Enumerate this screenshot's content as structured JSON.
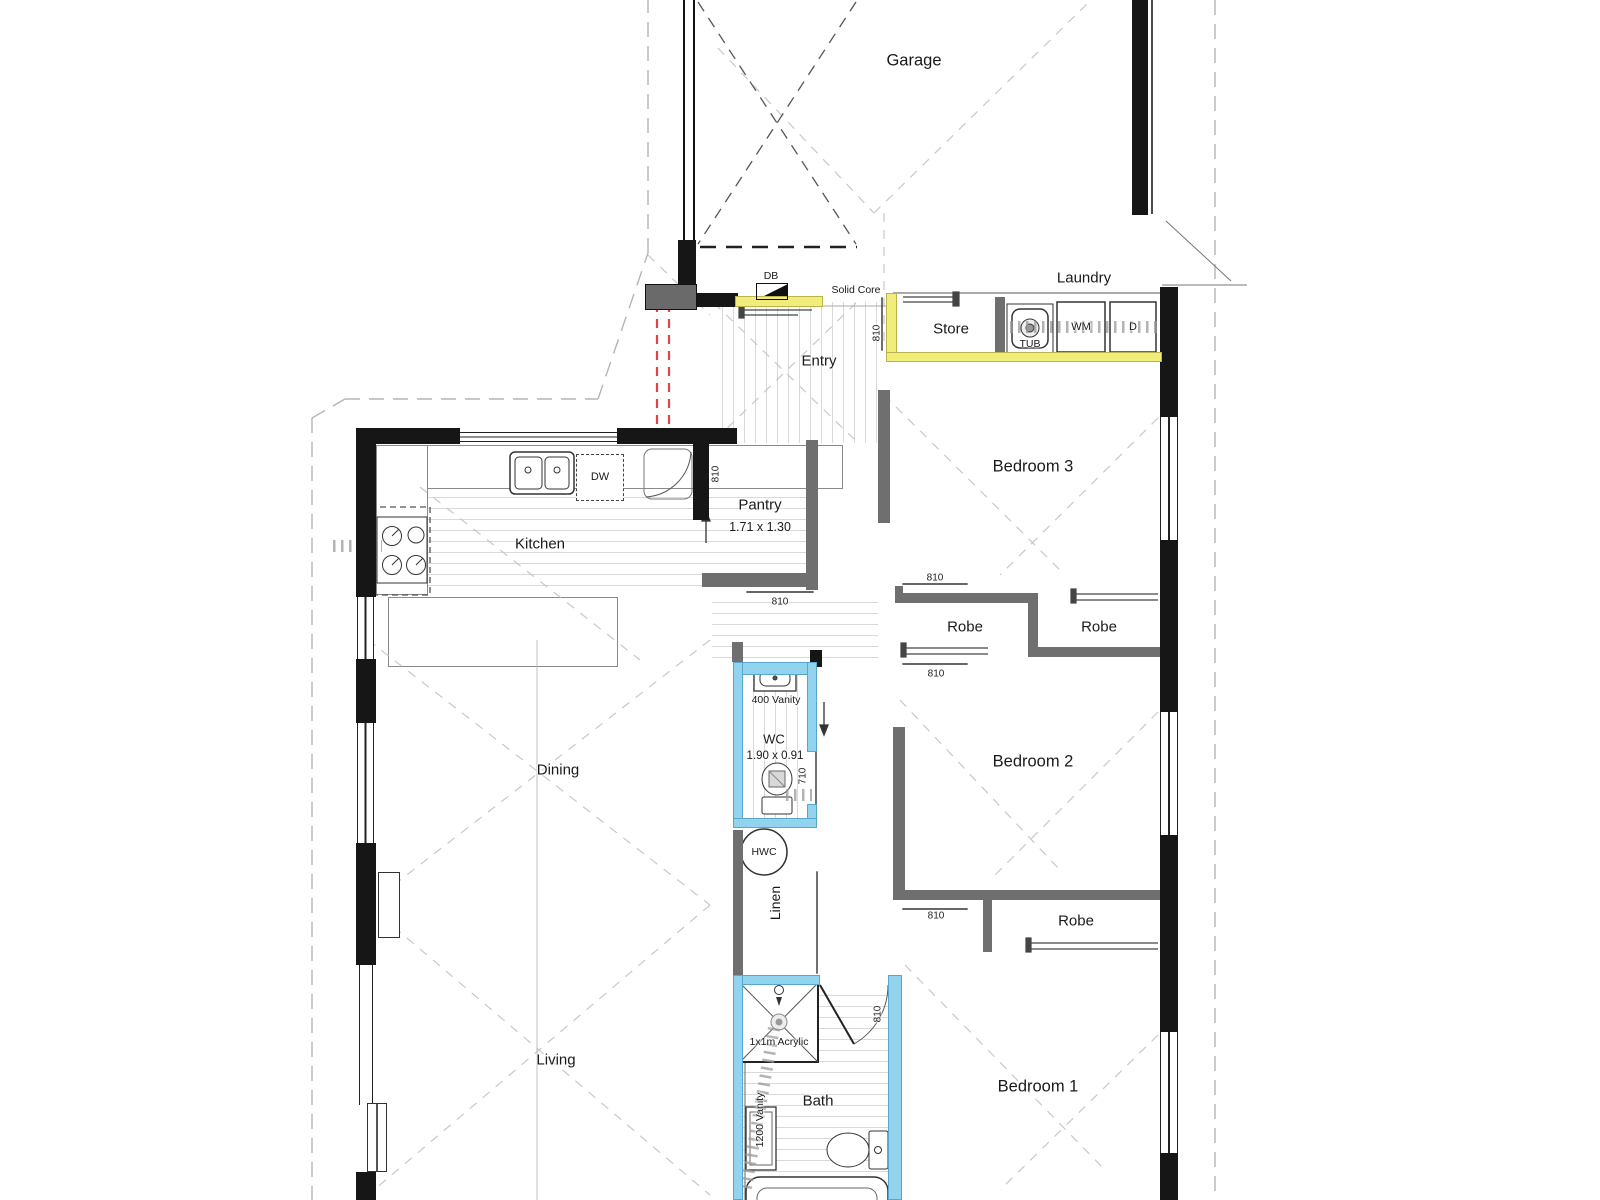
{
  "title": "Residential floor plan",
  "colors": {
    "fire_rated_wall": "#f1ed7b",
    "wet_area_wall": "#92d4ef",
    "alert_dashed": "#e04545",
    "wall_black": "#161616",
    "wall_grey": "#6f6f6f"
  },
  "rooms": {
    "garage": {
      "label": "Garage"
    },
    "laundry": {
      "label": "Laundry"
    },
    "store": {
      "label": "Store"
    },
    "entry": {
      "label": "Entry"
    },
    "kitchen": {
      "label": "Kitchen"
    },
    "pantry": {
      "label": "Pantry",
      "dims": "1.71 x 1.30"
    },
    "dining": {
      "label": "Dining"
    },
    "living": {
      "label": "Living"
    },
    "bedroom3": {
      "label": "Bedroom 3"
    },
    "bedroom2": {
      "label": "Bedroom 2"
    },
    "bedroom1": {
      "label": "Bedroom 1"
    },
    "robe_bed3_left": {
      "label": "Robe"
    },
    "robe_bed3_right": {
      "label": "Robe"
    },
    "robe_bed2": {
      "label": "Robe"
    },
    "wc": {
      "label": "WC",
      "dims": "1.90 x 0.91"
    },
    "linen": {
      "label": "Linen"
    },
    "bath": {
      "label": "Bath"
    }
  },
  "fixtures": {
    "db": "DB",
    "solid_core": "Solid Core",
    "tub": "TUB",
    "washing_machine": "WM",
    "dryer": "D",
    "dishwasher": "DW",
    "hot_water_cylinder": "HWC",
    "wc_vanity": "400 Vanity",
    "bath_vanity": "1200 Vanity",
    "shower": "1x1m Acrylic"
  },
  "door_tags": {
    "w810": "810",
    "w710": "710"
  }
}
